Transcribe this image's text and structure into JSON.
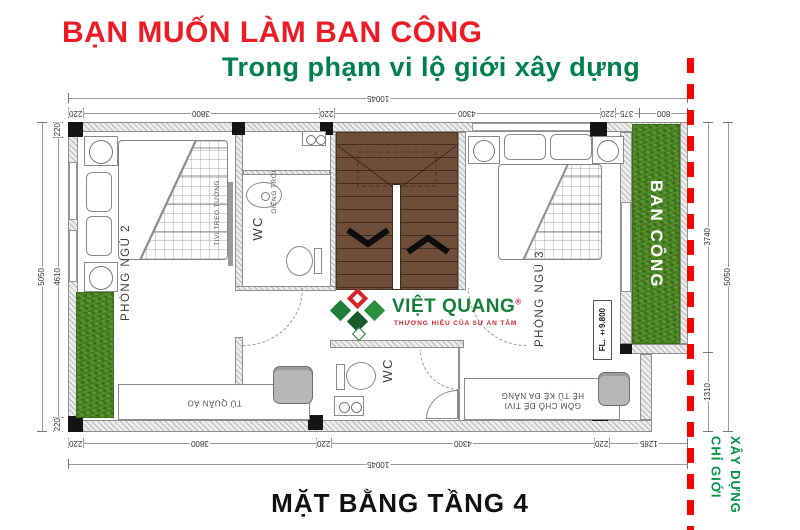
{
  "titles": {
    "headline": "BẠN MUỐN LÀM BAN CÔNG",
    "subheadline": "Trong phạm vi lộ giới xây dựng",
    "caption": "MẶT BẰNG TẦNG 4"
  },
  "boundary": {
    "line1": "CHỈ GIỚI",
    "line2": "XÂY DỰNG"
  },
  "logo": {
    "brand": "VIỆT QUANG",
    "registered": "®",
    "tagline": "THƯƠNG HIỆU CỦA SỰ AN TÂM"
  },
  "rooms": {
    "bedroom2": "PHÒNG NGỦ 2",
    "bedroom3": "PHÒNG NGỦ 3",
    "balcony": "BAN CÔNG",
    "wc_upper": "WC",
    "wc_lower": "WC",
    "lightwell": "GIẾNG TRỜI",
    "tv_wall": "TIVI TREO TƯỜNG",
    "wardrobe": "TỦ QUẦN ÁO",
    "shelf_line1": "HỆ TỦ KỆ ĐA NĂNG",
    "shelf_line2": "GỒM CHỖ ĐỂ TIVI",
    "floor_level": "FL.  ±9.800"
  },
  "dimensions": {
    "top_overall": "10045",
    "top_segments": [
      "220",
      "3800",
      "220",
      "4300",
      "220",
      "375",
      "800"
    ],
    "bottom_segments": [
      "220",
      "3800",
      "220",
      "4300",
      "220",
      "1285"
    ],
    "bottom_overall": "10045",
    "left_segments": [
      "220",
      "4610",
      "220"
    ],
    "left_overall": "5050",
    "right_segments": [
      "3740",
      "1310"
    ],
    "right_overall": "5050"
  },
  "colors": {
    "headline_red": "#ed1c24",
    "subheadline_green": "#00804d",
    "boundary_green": "#009245",
    "boundary_red": "#f50400",
    "grass_green": "#4c8a1f",
    "stair_brown": "#6f4e39",
    "logo_green": "#15803a",
    "logo_red": "#d6242b"
  }
}
